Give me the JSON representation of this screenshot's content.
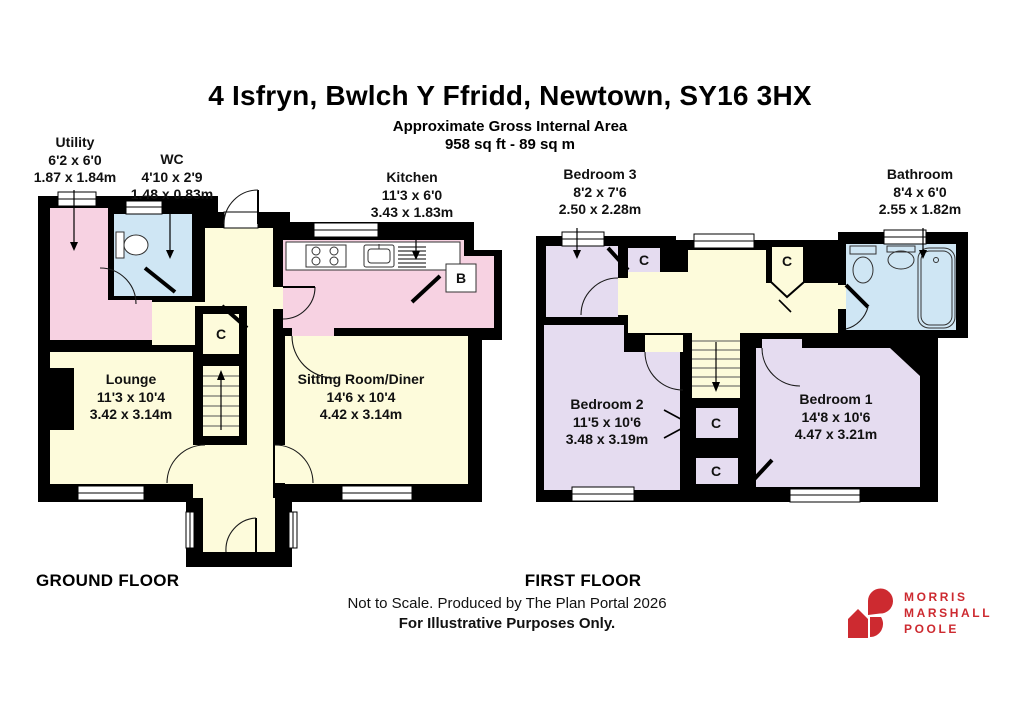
{
  "header": {
    "title": "4 Isfryn, Bwlch Y Ffridd, Newtown, SY16 3HX",
    "subtitle_line1": "Approximate Gross Internal Area",
    "subtitle_line2": "958 sq ft - 89 sq m"
  },
  "ground_floor": {
    "title": "GROUND FLOOR",
    "rooms": {
      "utility": {
        "name": "Utility",
        "imperial": "6'2 x 6'0",
        "metric": "1.87 x 1.84m"
      },
      "wc": {
        "name": "WC",
        "imperial": "4'10 x 2'9",
        "metric": "1.48 x 0.83m"
      },
      "kitchen": {
        "name": "Kitchen",
        "imperial": "11'3 x 6'0",
        "metric": "3.43 x 1.83m"
      },
      "lounge": {
        "name": "Lounge",
        "imperial": "11'3 x 10'4",
        "metric": "3.42 x 3.14m"
      },
      "sitting_room": {
        "name": "Sitting Room/Diner",
        "imperial": "14'6 x 10'4",
        "metric": "4.42 x 3.14m"
      }
    }
  },
  "first_floor": {
    "title": "FIRST FLOOR",
    "rooms": {
      "bedroom3": {
        "name": "Bedroom 3",
        "imperial": "8'2 x 7'6",
        "metric": "2.50 x 2.28m"
      },
      "bathroom": {
        "name": "Bathroom",
        "imperial": "8'4 x 6'0",
        "metric": "2.55 x 1.82m"
      },
      "bedroom2": {
        "name": "Bedroom 2",
        "imperial": "11'5 x 10'6",
        "metric": "3.48 x 3.19m"
      },
      "bedroom1": {
        "name": "Bedroom 1",
        "imperial": "14'8 x 10'6",
        "metric": "4.47 x 3.21m"
      }
    }
  },
  "annotations": {
    "cupboard": "C",
    "boiler": "B"
  },
  "footer": {
    "disclaimer_line1": "Not to Scale. Produced by The Plan Portal 2026",
    "disclaimer_line2": "For Illustrative Purposes Only."
  },
  "logo": {
    "name_line1": "MORRIS",
    "name_line2": "MARSHALL",
    "name_line3": "POOLE"
  },
  "colors": {
    "room_cream": "#FDFBDB",
    "room_pink": "#F7D2E2",
    "room_blue": "#CFE6F4",
    "room_purple": "#E5DCF0",
    "wall": "#000000",
    "logo_red": "#CD2A30"
  }
}
